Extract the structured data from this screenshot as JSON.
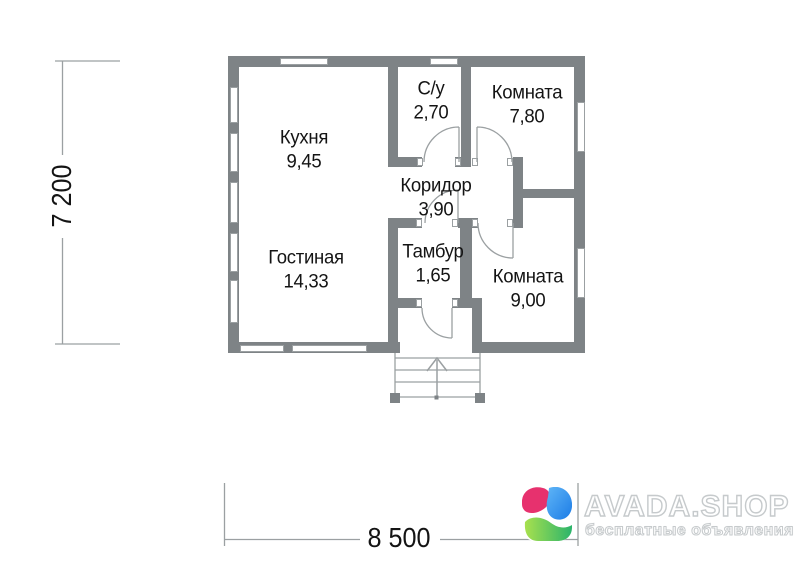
{
  "plan": {
    "rooms": [
      {
        "name": "Кухня",
        "area": "9,45"
      },
      {
        "name": "С/у",
        "area": "2,70"
      },
      {
        "name": "Комната",
        "area": "7,80"
      },
      {
        "name": "Коридор",
        "area": "3,90"
      },
      {
        "name": "Гостиная",
        "area": "14,33"
      },
      {
        "name": "Тамбур",
        "area": "1,65"
      },
      {
        "name": "Комната",
        "area": "9,00"
      }
    ],
    "dimensions": {
      "height": "7 200",
      "width": "8 500"
    }
  },
  "watermark": {
    "brand": "AVADA.SHOP",
    "tagline": "бесплатные объявления"
  },
  "colors": {
    "wall": "#7e8386",
    "thin_line": "#9ba0a2",
    "text": "#141414",
    "logo_pink": "#e7316e",
    "logo_blue": "#2e9af2",
    "logo_green": "#5ecb55"
  }
}
